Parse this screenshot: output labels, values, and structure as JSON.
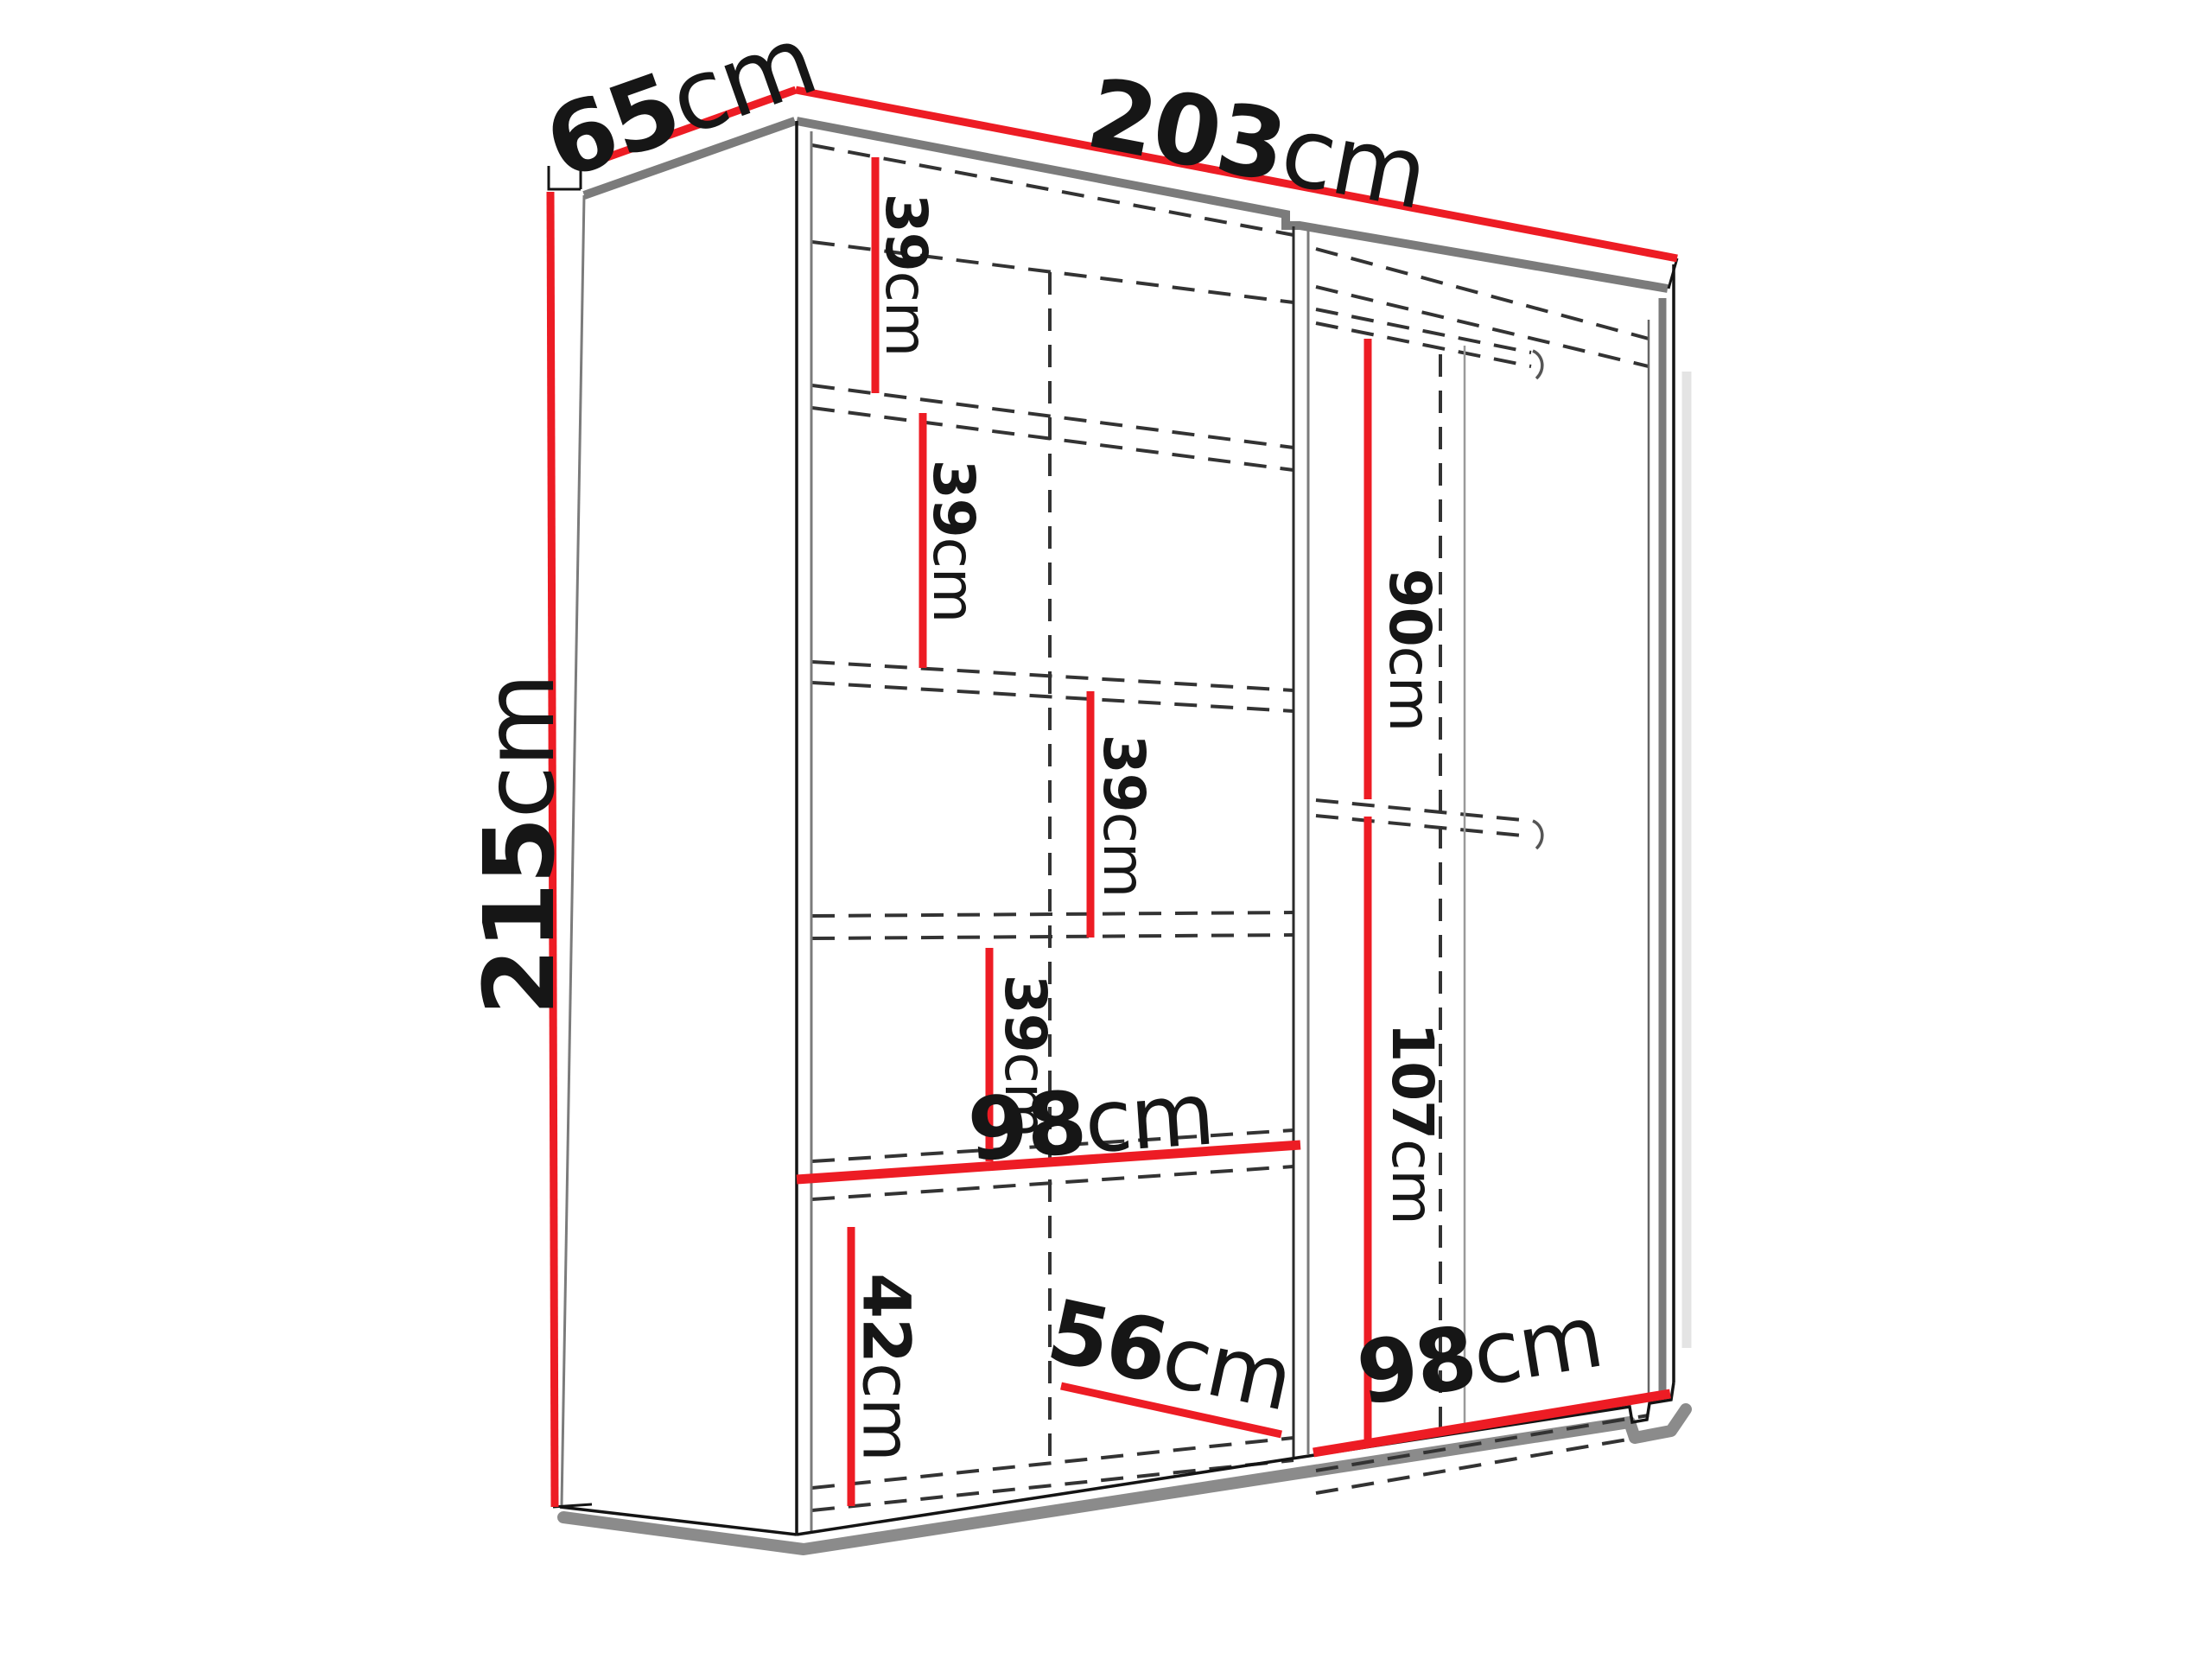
{
  "diagram": {
    "type": "furniture-dimension-diagram",
    "subject": "two-door sliding wardrobe with shelves and hanging rails, perspective line drawing",
    "unit": "cm",
    "colors": {
      "dimension_line": "#ed1c24",
      "edge_gray": "#7b7b7b",
      "outline_black": "#141414",
      "hidden_dashed": "#333333",
      "shadow": "#8b8b8b",
      "background": "#ffffff"
    },
    "dims": {
      "height": {
        "v": "215",
        "u": "cm"
      },
      "depth": {
        "v": "65",
        "u": "cm"
      },
      "width": {
        "v": "203",
        "u": "cm"
      },
      "shelf_gap_1": {
        "v": "39",
        "u": "cm"
      },
      "shelf_gap_2": {
        "v": "39",
        "u": "cm"
      },
      "shelf_gap_3": {
        "v": "39",
        "u": "cm"
      },
      "shelf_gap_4": {
        "v": "39",
        "u": "cm"
      },
      "bottom_comp": {
        "v": "42",
        "u": "cm"
      },
      "left_width": {
        "v": "98",
        "u": "cm"
      },
      "floor_depth": {
        "v": "56",
        "u": "cm"
      },
      "hang_top": {
        "v": "90",
        "u": "cm"
      },
      "hang_bottom": {
        "v": "107",
        "u": "cm"
      },
      "right_width": {
        "v": "98",
        "u": "cm"
      }
    }
  }
}
